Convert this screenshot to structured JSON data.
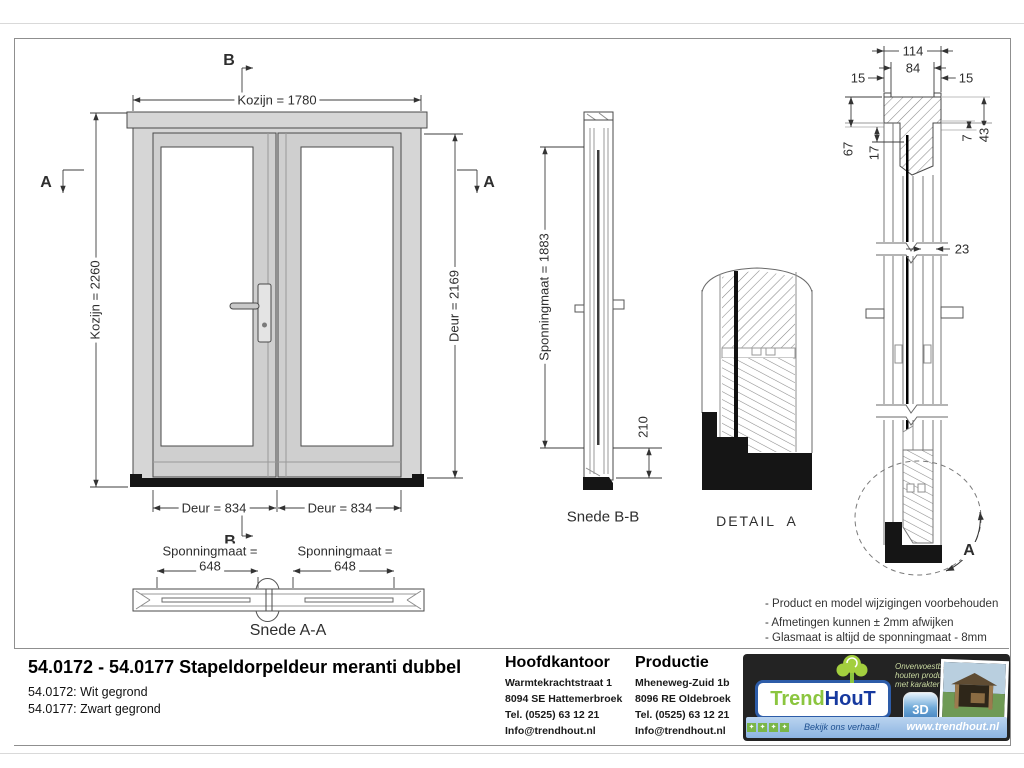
{
  "front": {
    "dim_top": "Kozijn = 1780",
    "dim_left": "Kozijn = 2260",
    "dim_right": "Deur = 2169",
    "dim_door_left": "Deur = 834",
    "dim_door_right": "Deur = 834",
    "marker_b_top": "B",
    "marker_b_bottom": "B",
    "marker_a_left": "A",
    "marker_a_right": "A"
  },
  "snede_aa": {
    "label": "Snede A-A",
    "left_line1": "Sponningmaat =",
    "left_line2": "648",
    "right_line1": "Sponningmaat =",
    "right_line2": "648"
  },
  "snede_bb": {
    "label": "Snede B-B",
    "dim_height": "Sponningmaat = 1883",
    "dim_bottom": "210"
  },
  "detail_a": {
    "label": "DETAIL  A"
  },
  "section": {
    "d114": "114",
    "d84": "84",
    "d15_left": "15",
    "d15_right": "15",
    "d67": "67",
    "d17": "17",
    "d7": "7",
    "d43": "43",
    "d23": "23",
    "marker_a": "A"
  },
  "notes": [
    "- Product en model wijzigingen voorbehouden",
    "- Afmetingen kunnen ± 2mm afwijken",
    "- Glasmaat is altijd de sponningmaat - 8mm"
  ],
  "titleblock": {
    "title": "54.0172 - 54.0177 Stapeldorpeldeur meranti dubbel",
    "variant1": "54.0172: Wit gegrond",
    "variant2": "54.0177: Zwart gegrond",
    "office": {
      "heading": "Hoofdkantoor",
      "lines": [
        "Warmtekrachtstraat 1",
        "8094 SE Hattemerbroek",
        "Tel. (0525) 63 12 21",
        "Info@trendhout.nl"
      ]
    },
    "production": {
      "heading": "Productie",
      "lines": [
        "Mheneweg-Zuid 1b",
        "8096 RE Oldebroek",
        "Tel. (0525) 63 12 21",
        "Info@trendhout.nl"
      ]
    },
    "logo": {
      "brand_part1": "Trend",
      "brand_part2": "HouT",
      "tagline1": "Onverwoestbare",
      "tagline2": "houten producten",
      "tagline3": "met karakter",
      "badge": "3D",
      "slogan": "Bekijk ons verhaal!",
      "website": "www.trendhout.nl",
      "colors": {
        "brand_green": "#8bc53f",
        "brand_blue": "#16399f",
        "bar_blue": "#9fc3e8"
      }
    }
  }
}
